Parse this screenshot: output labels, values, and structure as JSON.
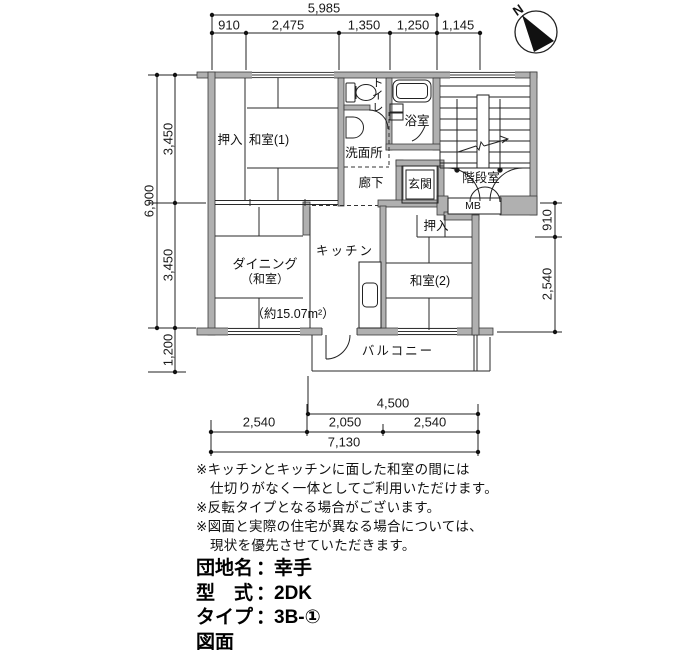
{
  "compass": {
    "north_label": "N"
  },
  "dimensions": {
    "top": {
      "total": "5,985",
      "seg1": "910",
      "seg2": "2,475",
      "seg3": "1,350",
      "seg4": "1,250",
      "seg5": "1,145"
    },
    "left": {
      "total": "6,900",
      "upper": "3,450",
      "lower": "3,450",
      "balcony": "1,200"
    },
    "right": {
      "upper": "910",
      "lower": "2,540"
    },
    "bottom": {
      "balcony_width": "4,500",
      "left": "2,540",
      "middle": "2,050",
      "right": "2,540",
      "total": "7,130"
    }
  },
  "rooms": {
    "closet_top": "押入",
    "washitsu1": "和室(1)",
    "toilet": "トイレ",
    "bath": "浴室",
    "washroom": "洗面所",
    "corridor": "廊下",
    "entrance": "玄関",
    "stairwell": "階段室",
    "meter_box": "MB",
    "closet_right": "押入",
    "kitchen": "キッチン",
    "dining": "ダイニング",
    "dining_sub": "（和室）",
    "washitsu2": "和室(2)",
    "balcony": "バルコニー",
    "area_note": "（約15.07m²）"
  },
  "notes": {
    "line1": "※キッチンとキッチンに面した和室の間には",
    "line2": "仕切りがなく一体としてご利用いただけます。",
    "line3": "※反転タイプとなる場合がございます。",
    "line4": "※図面と実際の住宅が異なる場合については、",
    "line5": "現状を優先させていただきます。"
  },
  "info": {
    "colon": "：",
    "row1_label": "団地名",
    "row1_value": "幸手",
    "row2_label": "型　式",
    "row2_value": "2DK",
    "row3_label": "タイプ",
    "row3_value": "3B-①",
    "row4_label": "図面No",
    "row4_value": "50152"
  }
}
